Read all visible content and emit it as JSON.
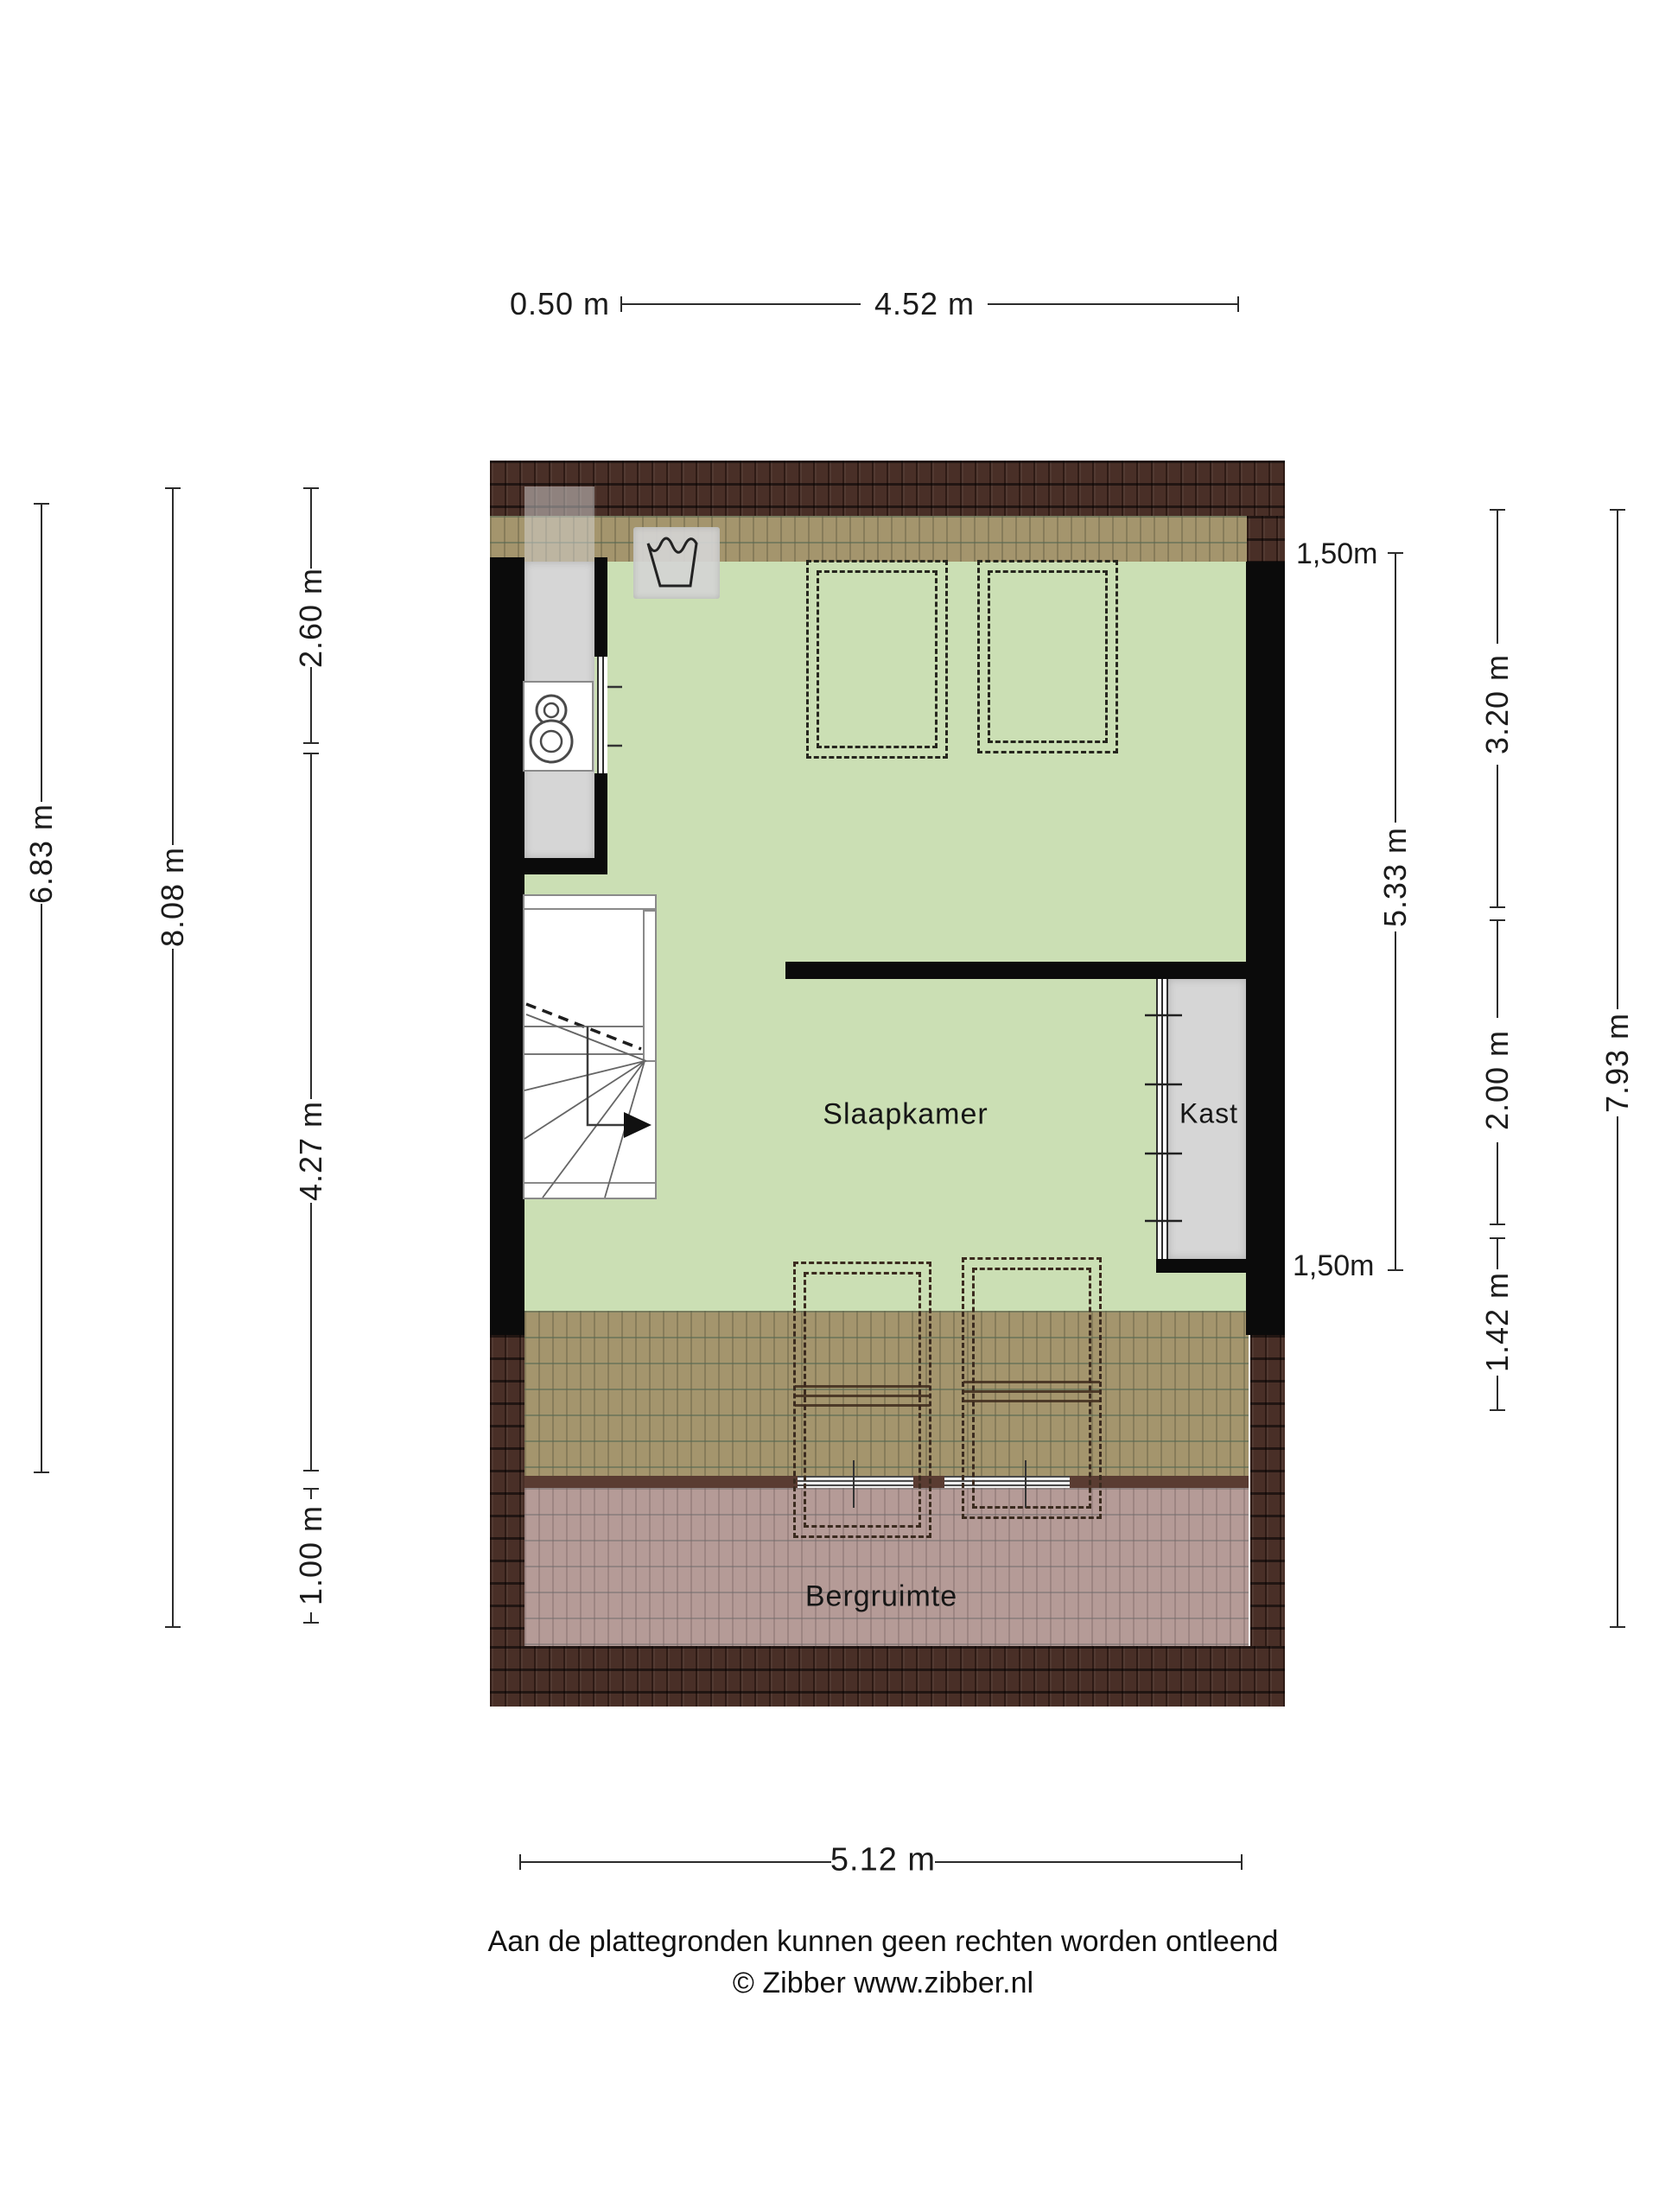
{
  "title": "Floor plan - attic storey (Zibber plattegrond)",
  "colors": {
    "floor_green": "#cbdfb4",
    "roof_dark_brown": "#492f27",
    "roof_tan_overlay": "#a4956d",
    "roof_pink_overlay": "#b59b97",
    "knee_wall_brown": "#5a3c32",
    "wall_black": "#0b0b0b",
    "closet_gray": "#d6d6d6",
    "text": "#1b1b1b"
  },
  "dimensions": {
    "top": [
      {
        "label": "0.50 m"
      },
      {
        "label": "4.52 m"
      }
    ],
    "left": [
      {
        "label": "6.83 m"
      },
      {
        "label": "8.08 m"
      },
      {
        "label": "2.60 m"
      },
      {
        "label": "4.27 m"
      },
      {
        "label": "1.00 m"
      }
    ],
    "right": [
      {
        "label": "1,50m"
      },
      {
        "label": "3.20 m"
      },
      {
        "label": "5.33 m"
      },
      {
        "label": "2.00 m"
      },
      {
        "label": "1,50m"
      },
      {
        "label": "1.42 m"
      },
      {
        "label": "7.93 m"
      }
    ],
    "bottom": [
      {
        "label": "5.12 m"
      }
    ]
  },
  "rooms": [
    {
      "name": "Slaapkamer"
    },
    {
      "name": "Kast"
    },
    {
      "name": "Bergruimte"
    }
  ],
  "icons": [
    {
      "name": "washing-machine-icon"
    },
    {
      "name": "boiler-icon"
    },
    {
      "name": "stairs-with-arrow"
    }
  ],
  "footer": {
    "disclaimer": "Aan de plattegronden kunnen geen rechten worden ontleend",
    "copyright": "© Zibber www.zibber.nl"
  }
}
